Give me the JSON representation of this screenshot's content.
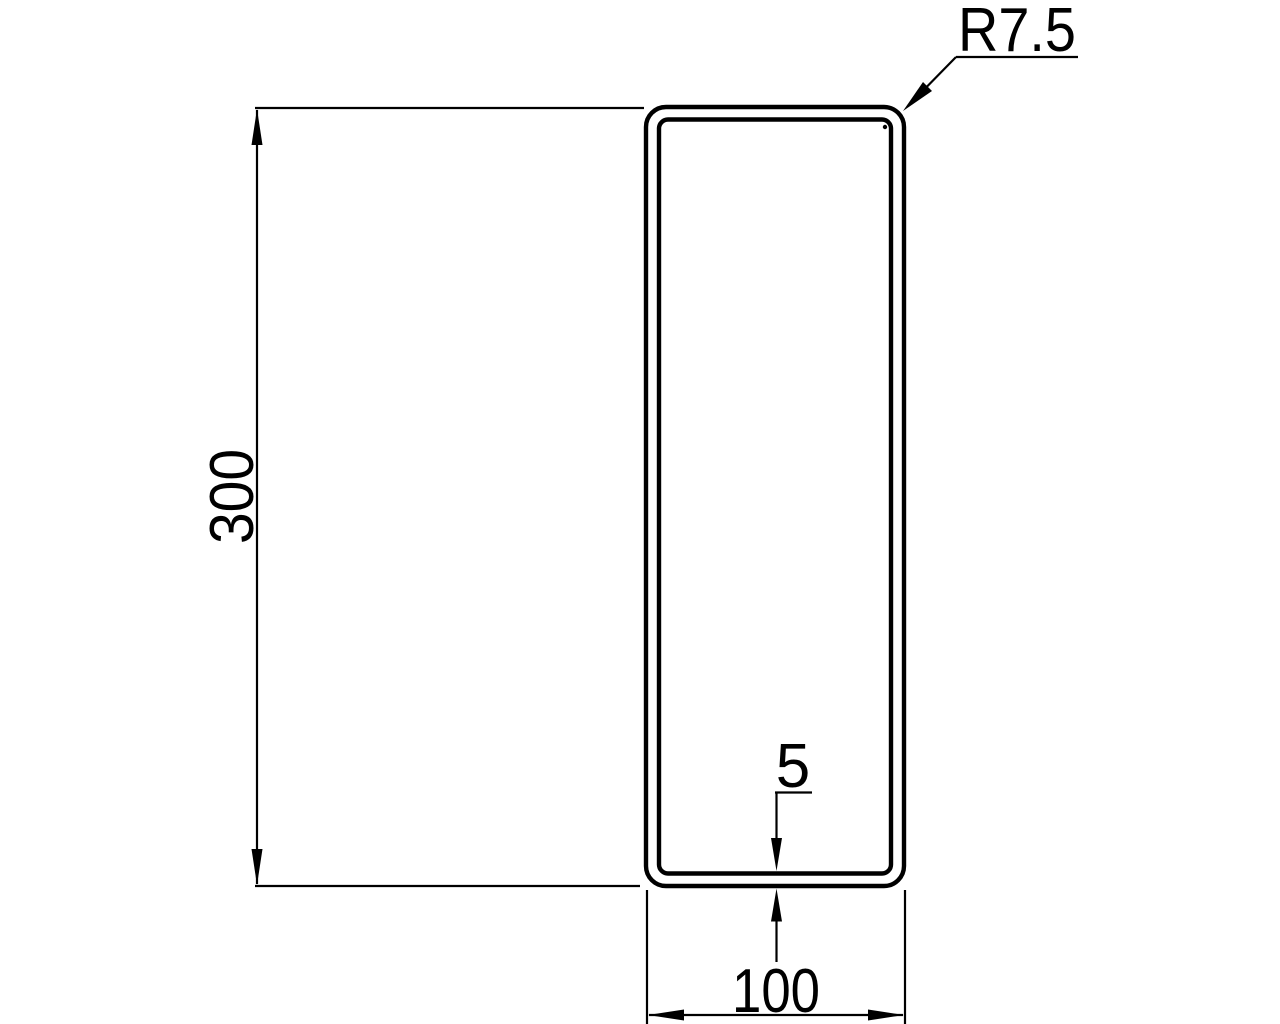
{
  "diagram": {
    "title": "rectangular-hollow-section-cross-section",
    "colors": {
      "line": "#000000",
      "background": "#ffffff"
    },
    "dimensions": {
      "height": {
        "label": "300",
        "value": 300,
        "orientation": "vertical",
        "side": "left"
      },
      "width": {
        "label": "100",
        "value": 100,
        "orientation": "horizontal",
        "side": "bottom"
      },
      "wall_thickness": {
        "label": "5",
        "value": 5,
        "orientation": "vertical",
        "side": "bottom-wall"
      },
      "corner_radius": {
        "label": "R7.5",
        "value": 7.5,
        "orientation": "leader",
        "side": "top-right"
      }
    }
  }
}
